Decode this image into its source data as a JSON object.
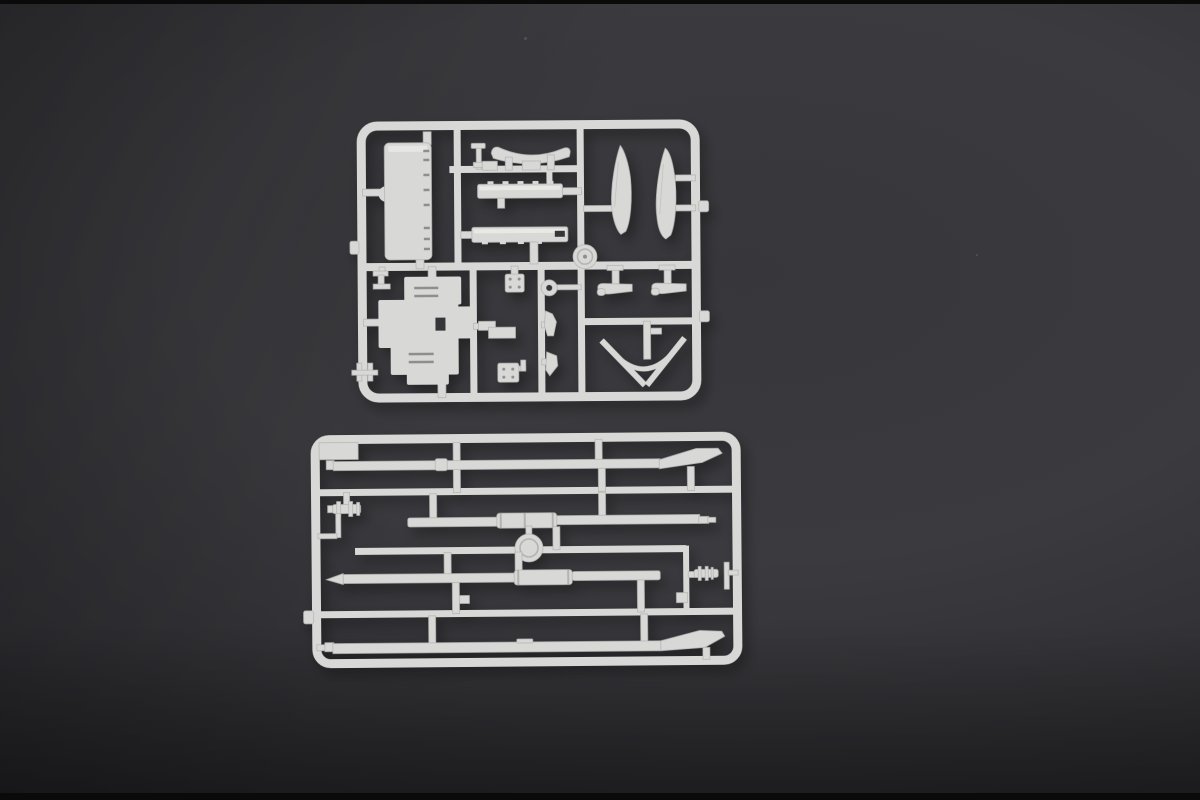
{
  "scene": {
    "description": "Studio photograph of two light-gray injection-molded plastic model-kit sprues (parts runners) lying on a dark charcoal background",
    "item_count_text": "2 sprues"
  },
  "colors": {
    "bg-top": "#37373b",
    "bg-mid": "#3b3b3f",
    "bg-low": "#2c2c30",
    "bg-deep": "#222226",
    "edge-strip": "#0a0a0b",
    "plastic": "#d8d8d6",
    "plastic-hi": "#ecece9",
    "plastic-edge": "#b3b3b1",
    "detail-dark": "#8e8e8c",
    "notch-dark": "#35353a"
  },
  "sprues": [
    {
      "name": "upper sprue",
      "description": "Square sprue frame holding ship superstructure parts: a notched side-deck strip, an anchor-davit arc, two slotted deck houses, two hull blade halves, two davit brackets, a V-shaped bow crane, a pulley disc, an eyelet ring, riveted plates, a stepped platform deck and small fittings",
      "parts": [
        "notched side-deck strip",
        "bollard post",
        "anchor-davit arc",
        "slotted deck house (upper)",
        "slotted deck house (lower)",
        "pulley disc",
        "hull blade half (left)",
        "hull blade half (right)",
        "davit bracket (left)",
        "davit bracket (right)",
        "V-shaped bow crane",
        "riveted plate (upper)",
        "eyelet ring",
        "axe fitting",
        "fin fitting",
        "riveted plate (lower)",
        "stepped platform deck",
        "corner bracket",
        "twin-post fitting"
      ]
    },
    {
      "name": "lower sprue",
      "description": "Rectangular sprue frame holding mast, yard and boom parts: two yardarms with swept blade tips, two masts with center sleeves, a sheave disc and two small capstan fittings",
      "parts": [
        "yardarm with blade tip (top)",
        "capstan fitting (left)",
        "mast with center sleeve (upper)",
        "sheave disc",
        "mast with tapered tip (lower)",
        "capstan fitting (right)",
        "yardarm with blade tip (bottom)"
      ]
    }
  ]
}
